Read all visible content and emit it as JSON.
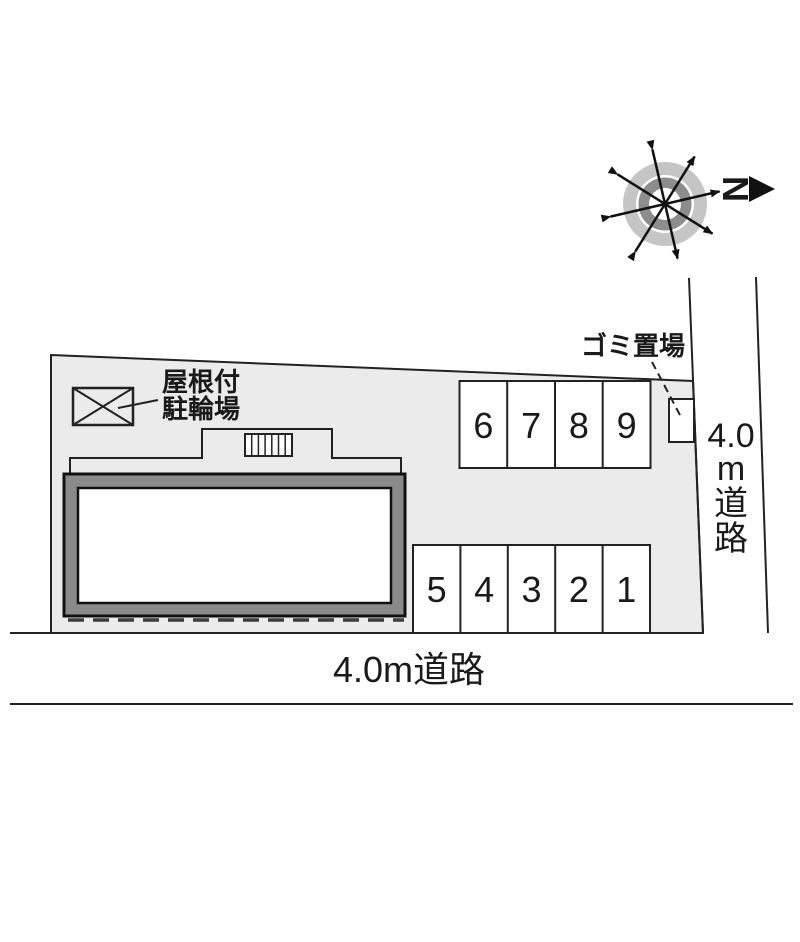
{
  "compass": {
    "north_label": "N"
  },
  "labels": {
    "garbage_area": "ゴミ置場",
    "bicycle_shed_line1": "屋根付",
    "bicycle_shed_line2": "駐輪場"
  },
  "roads": {
    "right": {
      "full": "4.0m道路",
      "num": "4.0",
      "unit": "m",
      "kanji_1": "道",
      "kanji_2": "路"
    },
    "bottom": {
      "full": "4.0m道路"
    }
  },
  "parking": {
    "top_row": [
      "6",
      "7",
      "8",
      "9"
    ],
    "bottom_row": [
      "5",
      "4",
      "3",
      "2",
      "1"
    ]
  },
  "colors": {
    "site_fill": "#ebebeb",
    "building_band": "#8a8a8a",
    "stall_fill": "#ffffff",
    "line": "#1a1a1a",
    "compass_outer_ring": "#c5c5c5",
    "compass_inner_ring": "#8d8d8d"
  }
}
